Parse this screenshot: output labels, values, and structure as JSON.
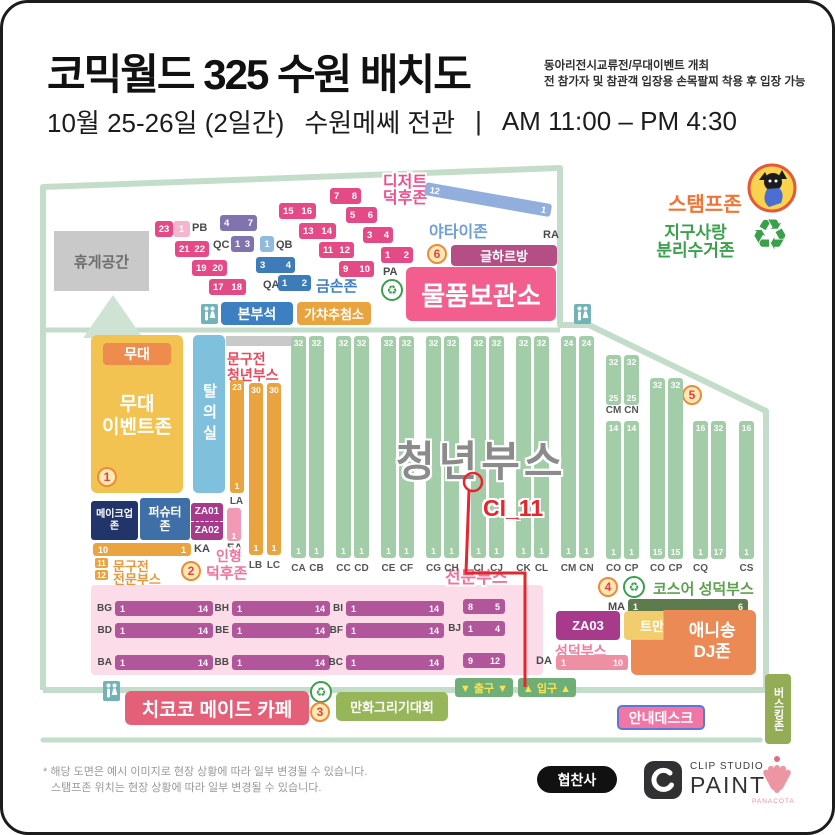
{
  "header": {
    "title": "코믹월드 325 수원 배치도",
    "note1": "동아리전시교류전/무대이벤트 개최",
    "note2": "전 참가자 및 참관객 입장용 손목팔찌 착용 후 입장 가능",
    "date": "10월 25-26일 (2일간)",
    "venue": "수원메쎄 전관",
    "divider": "|",
    "time": "AM 11:00 – PM 4:30"
  },
  "legend": {
    "stamp": "스탬프존",
    "earth1": "지구사랑",
    "earth2": "분리수거존",
    "recycle_icon": "♻"
  },
  "annex": {
    "rest": "휴게공간",
    "labels": {
      "pb": "PB",
      "pa": "PA",
      "qc": "QC",
      "qb": "QB",
      "qa": "QA",
      "ra": "RA"
    },
    "p_blocks": [
      {
        "l": "23"
      },
      {
        "l": "1",
        "light": true
      },
      {
        "l": "21",
        "r": "22"
      },
      {
        "l": "19",
        "r": "20"
      },
      {
        "l": "17",
        "r": "18"
      },
      {
        "l": "15",
        "r": "16"
      },
      {
        "l": "13",
        "r": "14"
      },
      {
        "l": "11",
        "r": "12"
      },
      {
        "l": "9",
        "r": "10"
      },
      {
        "l": "7",
        "r": "8"
      },
      {
        "l": "5",
        "r": "6"
      },
      {
        "l": "3",
        "r": "4"
      },
      {
        "l": "1",
        "r": "2"
      }
    ],
    "q_blocks": [
      {
        "l": "4",
        "r": "7",
        "c": "qpurple"
      },
      {
        "l": "1",
        "r": "3",
        "c": "qpurple"
      },
      {
        "l": "1",
        "c": "qlight"
      },
      {
        "l": "3",
        "r": "4",
        "c": "qblue"
      },
      {
        "l": "1",
        "r": "2",
        "c": "qblue"
      }
    ],
    "gold": "금손존",
    "dessert1": "디저트",
    "dessert2": "덕후존",
    "yatai": "야타이존",
    "ra_left": "12",
    "ra_right": "1",
    "num6": "6",
    "geulharbang": "글하르방",
    "storage": "물품보관소",
    "hq": "본부석",
    "gacha": "가챠추첨소"
  },
  "hall": {
    "stage_small": "무대",
    "stage1": "무대",
    "stage2": "이벤트존",
    "num1": "1",
    "dressing": "탈의실",
    "sy1": "문구전",
    "sy2": "청년부스",
    "l_cols": [
      {
        "label": "LA",
        "top": "23",
        "bottom": "1"
      },
      {
        "label": "LB",
        "top": "30",
        "bottom": "1"
      },
      {
        "label": "LC",
        "top": "30",
        "bottom": "1"
      }
    ],
    "makeup1": "메이크업",
    "makeup2": "존",
    "pershooter1": "퍼슈터",
    "pershooter2": "존",
    "za01": "ZA01",
    "za02": "ZA02",
    "ka": {
      "label": "KA",
      "l": "10",
      "r": "1"
    },
    "sp_n1": "11",
    "sp_n2": "12",
    "sp1": "문구전",
    "sp2": "전문부스",
    "ea": {
      "label": "EA",
      "bottom": "1"
    },
    "num2": "2",
    "doll1": "인형",
    "doll2": "덕후존",
    "title": "청년부스",
    "marker": "CI_11",
    "columns": [
      {
        "label": "CA",
        "top": "32",
        "bottom": "1"
      },
      {
        "label": "CB",
        "top": "32",
        "bottom": "1"
      },
      {
        "label": "CC",
        "top": "32",
        "bottom": "1"
      },
      {
        "label": "CD",
        "top": "32",
        "bottom": "1"
      },
      {
        "label": "CE",
        "top": "32",
        "bottom": "1"
      },
      {
        "label": "CF",
        "top": "32",
        "bottom": "1"
      },
      {
        "label": "CG",
        "top": "32",
        "bottom": "1"
      },
      {
        "label": "CH",
        "top": "32",
        "bottom": "1"
      },
      {
        "label": "CI",
        "top": "32",
        "bottom": "1"
      },
      {
        "label": "CJ",
        "top": "32",
        "bottom": "1"
      },
      {
        "label": "CK",
        "top": "32",
        "bottom": "1"
      },
      {
        "label": "CL",
        "top": "32",
        "bottom": "1"
      },
      {
        "label": "CM",
        "top": "24",
        "bottom": "1"
      },
      {
        "label": "CN",
        "top": "24",
        "bottom": "1"
      }
    ],
    "right_columns": [
      {
        "label": "CM",
        "top": "32",
        "bottom": "25"
      },
      {
        "label": "CN",
        "top": "32",
        "bottom": "25"
      },
      {
        "label": "CO",
        "top": "14",
        "bottom": "1"
      },
      {
        "label": "CP",
        "top": "14",
        "bottom": "1"
      },
      {
        "label": "CO",
        "top": "32",
        "bottom": "15"
      },
      {
        "label": "CP",
        "top": "32",
        "bottom": "15"
      },
      {
        "label": "CQ",
        "top": "16",
        "bottom": "1"
      },
      {
        "label": "",
        "top": "32",
        "bottom": "17"
      },
      {
        "label": "CS",
        "top": "16",
        "bottom": "1"
      }
    ],
    "num5": "5",
    "pro_label": "전문부스",
    "b_bars": [
      {
        "label": "BG",
        "l": "1",
        "r": "14"
      },
      {
        "label": "BH",
        "l": "1",
        "r": "14"
      },
      {
        "label": "BI",
        "l": "1",
        "r": "14"
      },
      {
        "label": "BD",
        "l": "1",
        "r": "14"
      },
      {
        "label": "BE",
        "l": "1",
        "r": "14"
      },
      {
        "label": "BF",
        "l": "1",
        "r": "14"
      },
      {
        "label": "BA",
        "l": "1",
        "r": "14"
      },
      {
        "label": "BB",
        "l": "1",
        "r": "14"
      },
      {
        "label": "BC",
        "l": "1",
        "r": "14"
      }
    ],
    "b_short": [
      {
        "l": "8",
        "r": "5"
      },
      {
        "label": "BJ",
        "l": "1",
        "r": "4"
      },
      {
        "l": "9",
        "r": "12"
      }
    ],
    "num4": "4",
    "cos": "코스어 성덕부스",
    "ma": {
      "label": "MA",
      "l": "1",
      "r": "6"
    },
    "za03": "ZA03",
    "tman": "트만장",
    "ani1": "애니송",
    "ani2": "DJ존",
    "seongdeok": "성덕부스",
    "da": {
      "label": "DA",
      "l": "1",
      "r": "10"
    }
  },
  "bottom": {
    "maid": "치코코 메이드 카페",
    "num3": "3",
    "drawing": "만화그리기대회",
    "exit": "▼ 출구 ▼",
    "entry": "▲ 입구 ▲",
    "info": "안내데스크",
    "busking": "버스킹존"
  },
  "footer": {
    "note1": "* 해당 도면은 예시 이미지로 현장 상황에 따라 일부 변경될 수 있습니다.",
    "note2": "스탬프존 위치는 현장 상황에 따라 일부 변경될 수 있습니다.",
    "sponsor": "협찬사",
    "cs1": "CLIP STUDIO",
    "cs2": "PAINT",
    "panacota": "PANACOTA"
  },
  "colors": {
    "wall": "#c4ddca",
    "booth_green": "#a3cda8",
    "pink": "#e44b86",
    "accent_pink": "#f25e8d",
    "orange": "#e9a43f",
    "red": "#e5262b",
    "olive": "#97b559",
    "mauve": "#b1569b"
  }
}
